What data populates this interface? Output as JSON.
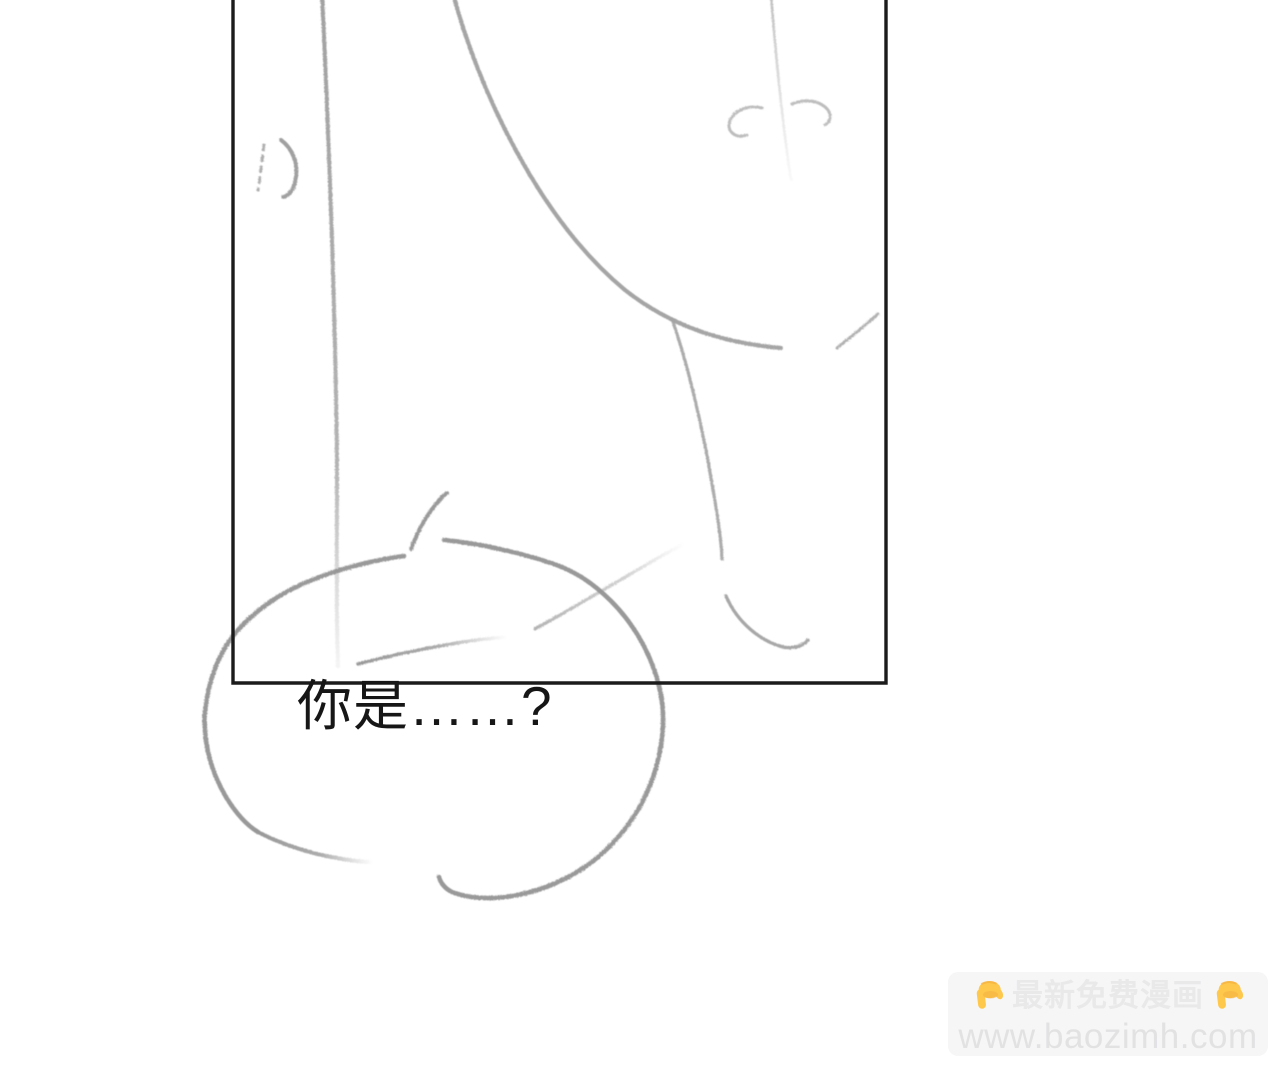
{
  "speech_bubble": {
    "text": "你是……?",
    "text_color": "#161616"
  },
  "watermark": {
    "badge_title": "最新免费漫画",
    "badge_url": "www.baozimh.com",
    "left_icon": {
      "name": "pointing-down-hand-icon",
      "glyph": "👇"
    },
    "right_icon": {
      "name": "pointing-down-hand-icon",
      "glyph": "👇"
    },
    "colors": {
      "background": "#f6f6f7",
      "title_text": "#e9e9ea",
      "url_text": "#e2e2e3",
      "hand_yellow": "#fec84d",
      "hand_shadow": "#f2ae3e"
    }
  },
  "panel": {
    "border_color": "#1b1b1b"
  },
  "sketch": {
    "pencil_color": "#979797"
  }
}
